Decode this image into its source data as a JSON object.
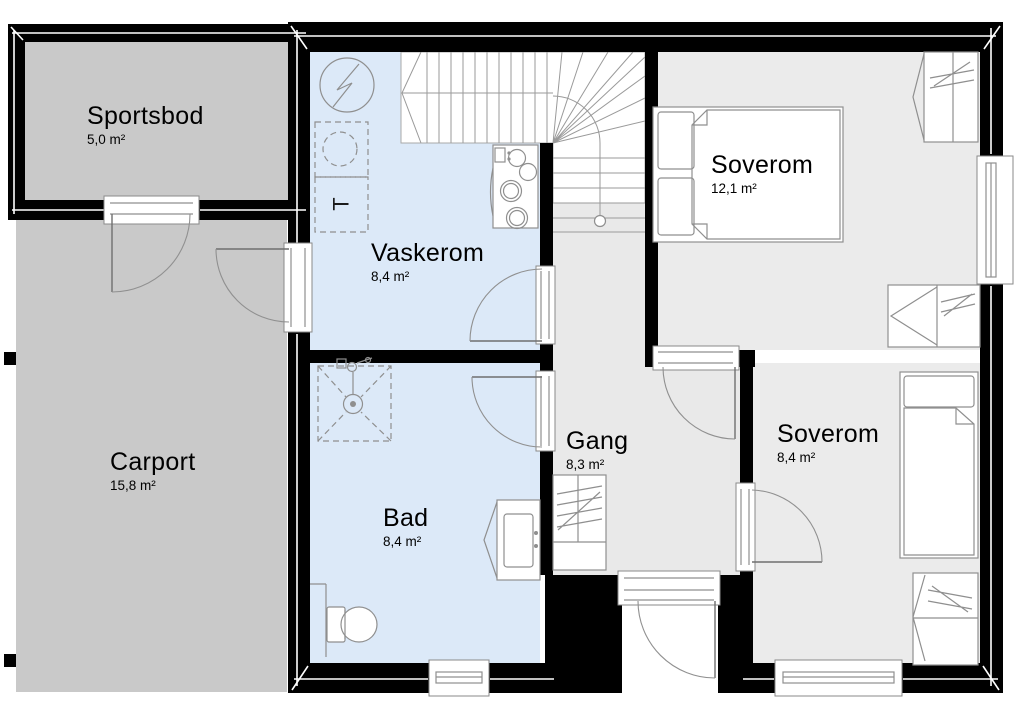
{
  "colors": {
    "background": "#ffffff",
    "wall": "#000000",
    "storage": "#c9c9c9",
    "wet": "#dce9f8",
    "room": "#ebebeb",
    "hall": "#e9e9e9",
    "stair": "#ffffff",
    "furniture_line": "#8f8f8f",
    "text": "#000000"
  },
  "rooms": [
    {
      "name": "Sportsbod",
      "area": "5,0 m²"
    },
    {
      "name": "Carport",
      "area": "15,8 m²"
    },
    {
      "name": "Vaskerom",
      "area": "8,4 m²"
    },
    {
      "name": "Bad",
      "area": "8,4 m²"
    },
    {
      "name": "Gang",
      "area": "8,3 m²"
    },
    {
      "name": "Soverom",
      "area": "12,1 m²"
    },
    {
      "name": "Soverom",
      "area": "8,4 m²"
    }
  ],
  "symbols": {
    "dryer": "T"
  }
}
